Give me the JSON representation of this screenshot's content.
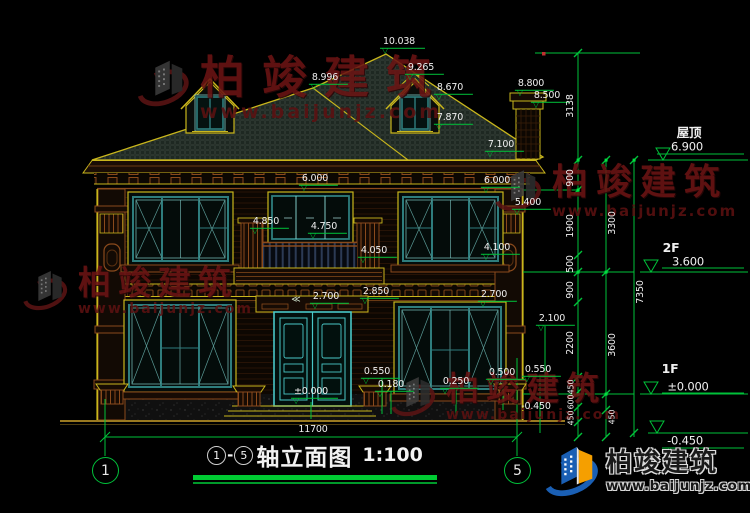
{
  "drawing_title": {
    "axis_start": "1",
    "separator": "-",
    "axis_end": "5",
    "title": "轴立面图",
    "scale": "1:100"
  },
  "axis_bubbles": {
    "left": "1",
    "right": "5"
  },
  "overall_dimension": "11700",
  "watermark": {
    "text": "柏竣建筑",
    "url": "www.baijunjz.com"
  },
  "brand_logo": {
    "name": "柏竣建筑",
    "website": "www.baijunjz.com"
  },
  "colors": {
    "cad_yellow": "#c9b61c",
    "cad_green": "#00c23a",
    "cad_teal": "#2e7d7d",
    "door_cyan": "#49c7c7",
    "wall_brown": "#8a4a1c",
    "watermark_red": "#6b1414",
    "brand_blue": "#1a5fb4",
    "brand_orange": "#f59f00"
  },
  "annotations": [
    {
      "text": "10.038",
      "x": 399,
      "y": 42,
      "type": "dim",
      "marker": true
    },
    {
      "text": "9.265",
      "x": 421,
      "y": 68,
      "type": "dim",
      "marker": true
    },
    {
      "text": "8.670",
      "x": 450,
      "y": 88,
      "type": "dim",
      "marker": true
    },
    {
      "text": "7.870",
      "x": 450,
      "y": 118,
      "type": "dim",
      "marker": true
    },
    {
      "text": "8.996",
      "x": 325,
      "y": 78,
      "type": "dim",
      "marker": true
    },
    {
      "text": "8.800",
      "x": 531,
      "y": 84,
      "type": "dim",
      "marker": true
    },
    {
      "text": "8.500",
      "x": 547,
      "y": 96,
      "type": "dim",
      "marker": true
    },
    {
      "text": "7.100",
      "x": 501,
      "y": 145,
      "type": "dim",
      "marker": true
    },
    {
      "text": "6.000",
      "x": 315,
      "y": 179,
      "type": "dim",
      "marker": true
    },
    {
      "text": "6.000",
      "x": 497,
      "y": 181,
      "type": "dim",
      "marker": true
    },
    {
      "text": "5.400",
      "x": 528,
      "y": 203,
      "type": "dim",
      "marker": true
    },
    {
      "text": "4.850",
      "x": 266,
      "y": 222,
      "type": "dim",
      "marker": true
    },
    {
      "text": "4.750",
      "x": 324,
      "y": 227,
      "type": "dim",
      "marker": true
    },
    {
      "text": "4.050",
      "x": 374,
      "y": 251,
      "type": "dim",
      "marker": true
    },
    {
      "text": "4.100",
      "x": 497,
      "y": 248,
      "type": "dim",
      "marker": true
    },
    {
      "text": "2.850",
      "x": 376,
      "y": 292,
      "type": "dim",
      "marker": true
    },
    {
      "text": "2.700",
      "x": 326,
      "y": 297,
      "type": "dim",
      "marker": true
    },
    {
      "text": "2.700",
      "x": 494,
      "y": 295,
      "type": "dim",
      "marker": true
    },
    {
      "text": "2.100",
      "x": 552,
      "y": 319,
      "type": "dim",
      "marker": true
    },
    {
      "text": "±0.000",
      "x": 311,
      "y": 392,
      "type": "dim",
      "marker": true
    },
    {
      "text": "0.550",
      "x": 377,
      "y": 372,
      "type": "dim",
      "marker": true
    },
    {
      "text": "0.180",
      "x": 391,
      "y": 385,
      "type": "dim",
      "marker": true
    },
    {
      "text": "0.250",
      "x": 456,
      "y": 382,
      "type": "dim",
      "marker": true
    },
    {
      "text": "0.500",
      "x": 502,
      "y": 373,
      "type": "dim",
      "marker": true
    },
    {
      "text": "0.550",
      "x": 538,
      "y": 370,
      "type": "dim",
      "marker": true
    },
    {
      "text": "-0.450",
      "x": 536,
      "y": 407,
      "type": "dim",
      "marker": false
    },
    {
      "text": "≪",
      "x": 295,
      "y": 301,
      "type": "arrows",
      "marker": false
    },
    {
      "text": "11700",
      "x": 313,
      "y": 430,
      "type": "dim",
      "marker": false
    },
    {
      "text": "屋顶",
      "x": 689,
      "y": 133,
      "type": "floor",
      "marker": false
    },
    {
      "text": "6.900",
      "x": 687,
      "y": 147,
      "type": "dimbig",
      "marker": false
    },
    {
      "text": "2F",
      "x": 671,
      "y": 248,
      "type": "floor",
      "marker": false
    },
    {
      "text": "3.600",
      "x": 688,
      "y": 262,
      "type": "dimbig",
      "marker": false
    },
    {
      "text": "1F",
      "x": 670,
      "y": 369,
      "type": "floor",
      "marker": false
    },
    {
      "text": "±0.000",
      "x": 688,
      "y": 387,
      "type": "dimbig",
      "marker": false
    },
    {
      "text": "-0.450",
      "x": 685,
      "y": 441,
      "type": "dimbig",
      "marker": false
    },
    {
      "text": "3138",
      "x": 571,
      "y": 106,
      "type": "dimv"
    },
    {
      "text": "900",
      "x": 571,
      "y": 178,
      "type": "dimv"
    },
    {
      "text": "1900",
      "x": 571,
      "y": 226,
      "type": "dimv"
    },
    {
      "text": "500",
      "x": 571,
      "y": 264,
      "type": "dimv"
    },
    {
      "text": "900",
      "x": 571,
      "y": 290,
      "type": "dimv"
    },
    {
      "text": "2200",
      "x": 571,
      "y": 343,
      "type": "dimv"
    },
    {
      "text": "450",
      "x": 572,
      "y": 387,
      "type": "dimv2"
    },
    {
      "text": "600",
      "x": 572,
      "y": 402,
      "type": "dimv2"
    },
    {
      "text": "450",
      "x": 572,
      "y": 418,
      "type": "dimv2"
    },
    {
      "text": "3300",
      "x": 613,
      "y": 223,
      "type": "dimv"
    },
    {
      "text": "3600",
      "x": 613,
      "y": 345,
      "type": "dimv"
    },
    {
      "text": "450",
      "x": 613,
      "y": 417,
      "type": "dimv2"
    },
    {
      "text": "7350",
      "x": 641,
      "y": 292,
      "type": "dimv"
    }
  ]
}
